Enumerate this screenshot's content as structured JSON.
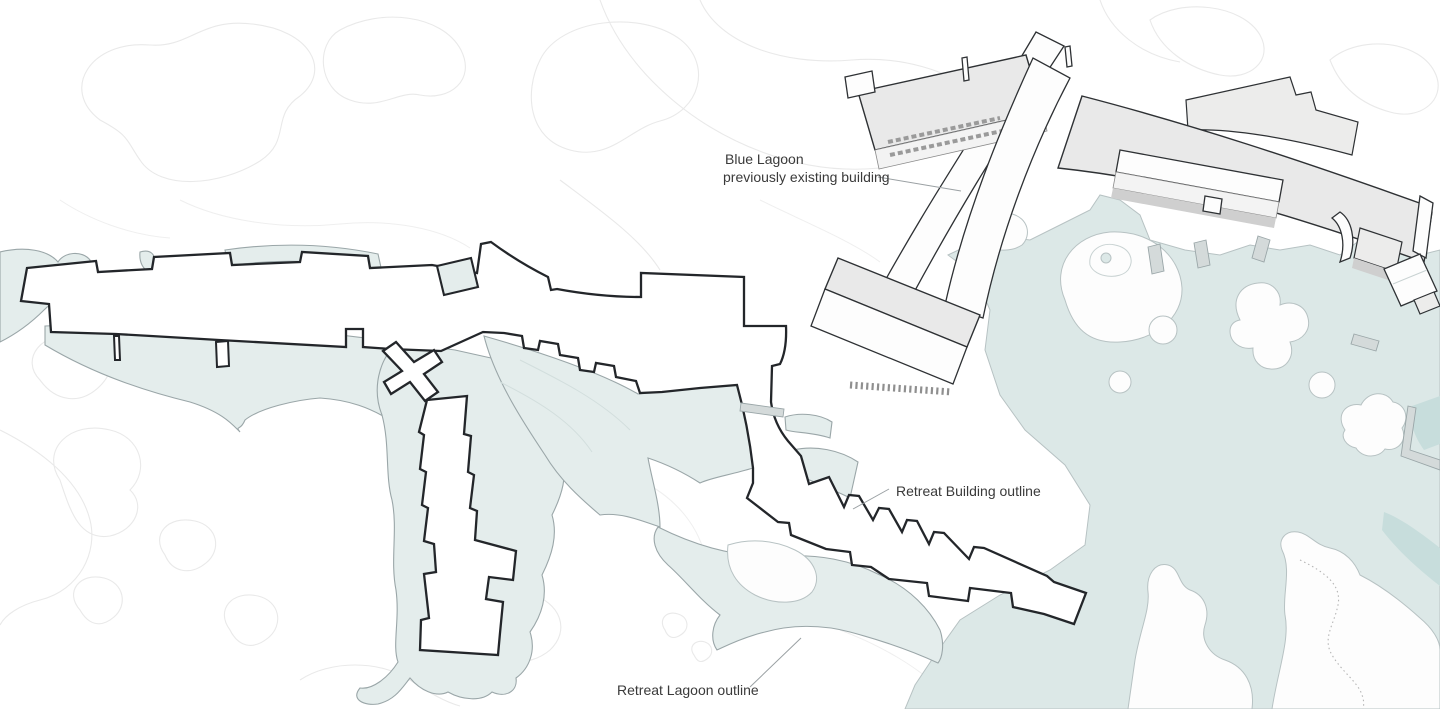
{
  "labels": {
    "existing_building_line1": "Blue Lagoon",
    "existing_building_line2": "previously existing building",
    "retreat_building": "Retreat Building outline",
    "retreat_lagoon": "Retreat Lagoon outline"
  },
  "colors": {
    "water_fill": "#dce8e7",
    "water_stroke": "#b7c2c3",
    "lagoon_fill": "#e4edec",
    "lagoon_stroke": "#9aa6a8",
    "building_roof": "#e9e9e9",
    "building_outline": "#2e3134",
    "retreat_outline": "#23262a",
    "contour": "#e9e9e9",
    "label_text": "#3a3a3a",
    "leader": "#9aa0a3"
  }
}
